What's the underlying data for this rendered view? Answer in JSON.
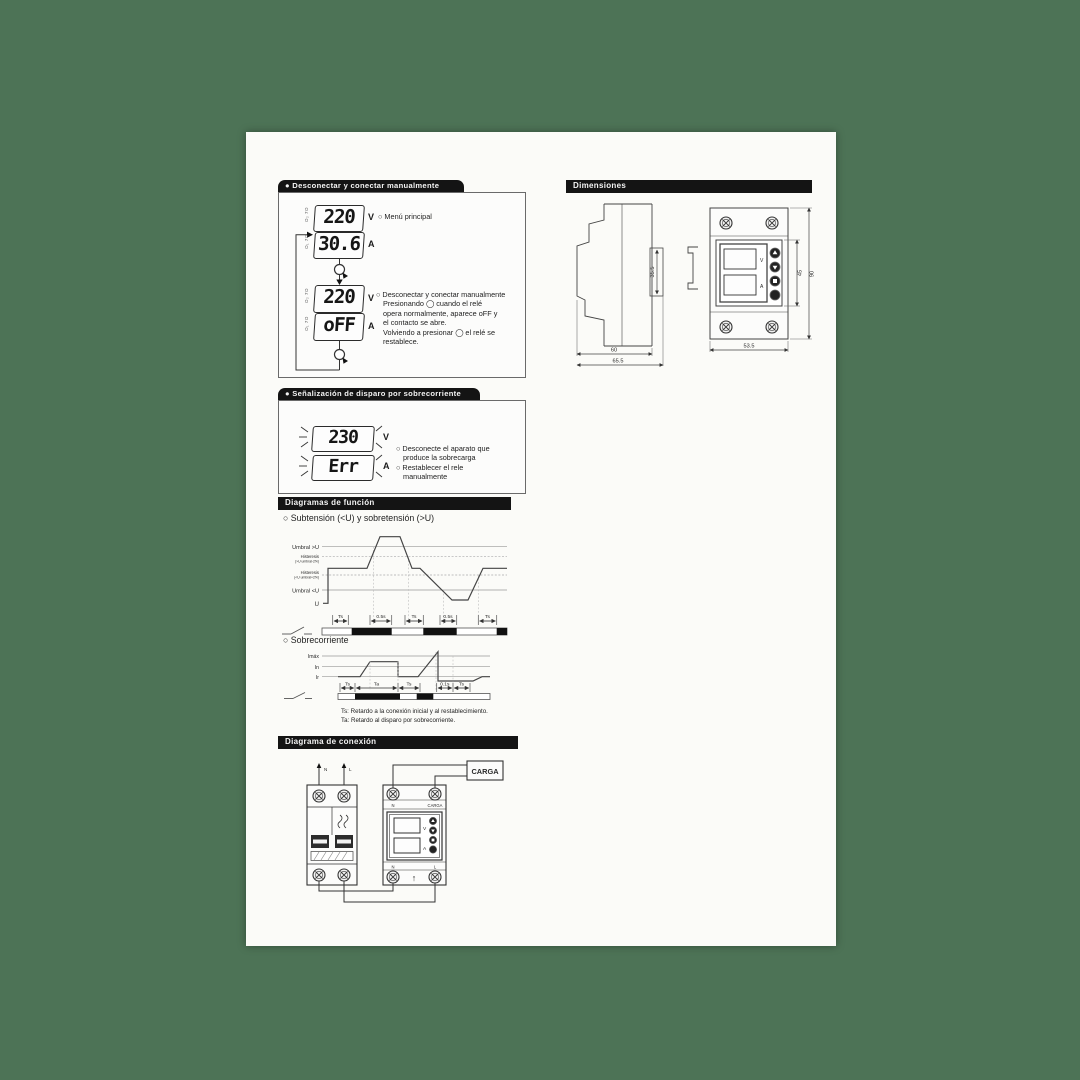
{
  "colors": {
    "background": "#4d7356",
    "paper": "#fbfbf8",
    "header_bar": "#141414",
    "ink": "#2a2a2a"
  },
  "sec1": {
    "header": "● Desconectar y conectar manualmente",
    "menu_note": "○ Menú principal",
    "lcd_v1": "220",
    "lcd_a1": "30.6",
    "lcd_v2": "220",
    "lcd_a2": "oFF",
    "unit_v": "V",
    "unit_a": "A",
    "mark_v": "O₂ 7O",
    "mark_a": "O₁ 7O",
    "body": [
      "○ Desconectar y conectar manualmente",
      "Presionando ◯ cuando el relé",
      "opera normalmente, aparece oFF y",
      "el contacto se abre.",
      "Volviendo a presionar ◯ el relé se",
      "restablece."
    ]
  },
  "sec2": {
    "header": "● Señalización de disparo por sobrecorriente",
    "lcd_v": "230",
    "lcd_a": "Err",
    "unit_v": "V",
    "unit_a": "A",
    "body": [
      "○ Desconecte el aparato que",
      "produce la sobrecarga",
      "○ Restablecer el rele",
      "manualmente"
    ]
  },
  "fn": {
    "title": "Diagramas de función",
    "sub1": "○ Subtensión (<U) y sobretensión (>U)",
    "sub2": "○ Sobrecorriente",
    "umbral_hi": "Umbral >U",
    "hist": "Histeresis",
    "hist_hi_note": "(>U umbral-2%)",
    "hist_lo_note": "(<U umbral+2%)",
    "umbral_lo": "Umbral <U",
    "u": "U",
    "ts": "Ts",
    "t05": "0.5s",
    "ta": "Ta",
    "t01": "0.1s",
    "imax": "Imáx",
    "iin": "In",
    "ir": "Ir",
    "note_ts": "Ts: Retardo a la conexión inicial y al restablecimiento.",
    "note_ta": "Ta: Retardo al disparo por sobrecorriente."
  },
  "conn": {
    "title": "Diagrama de conexión",
    "n": "N",
    "l": "L",
    "carga": "CARGA",
    "up": "↑",
    "v": "V",
    "a": "A"
  },
  "dims": {
    "title": "Dimensiones",
    "d355": "35.5",
    "d60": "60",
    "d655": "65.5",
    "d45": "45",
    "d90": "90",
    "d535": "53.5"
  }
}
